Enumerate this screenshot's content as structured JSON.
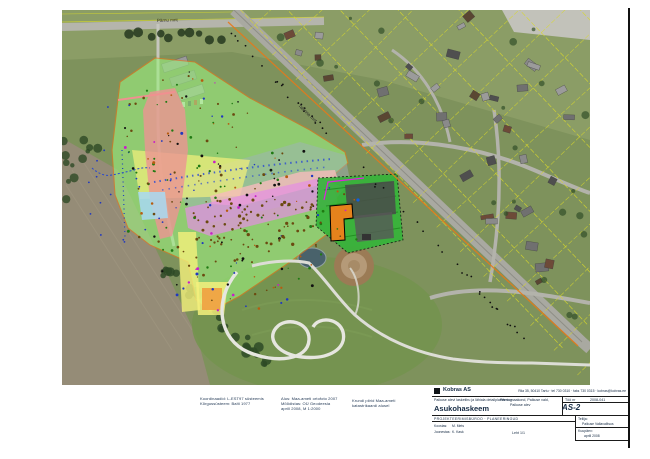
{
  "colors": {
    "zone_green": "#9CEF7E",
    "zone_red": "#EC9494",
    "zone_yellow": "#F4F07C",
    "zone_blue": "#A8D9F2",
    "zone_magenta": "#E48FE3",
    "zone_pink": "#F6BCBC",
    "zone_gray": "#9FB2BE",
    "facility_green": "#36B43A",
    "building_orange": "#E5821C",
    "boundary_orange": "#E87818",
    "parcel_yellow": "#D9D92A",
    "pond": "#49626B",
    "arena_brown": "#9B7B55"
  },
  "map_labels": {
    "street_top": "Pärnu mnt",
    "street_diagonal": "Tallinna mnt"
  },
  "notes": {
    "n1": [
      "Koordinaadid: L-EST97 süsteemis",
      "Kõrgussüsteem: Balti 1977"
    ],
    "n2": [
      "Alus: Maa-ameti ortofoto 2007",
      "Mõõdistas: OÜ Geodeesia",
      "aprill 2008, M 1:2000"
    ],
    "n3": [
      "Krundi piirid Maa-ameti",
      "katastrikaardi alusel"
    ]
  },
  "title_block": {
    "company": "Kobras AS",
    "contacts": "Riia 35, 50410 Tartu · tel 730 0310 · faks 730 0315 · kobras@kobras.ee",
    "project_line": "Paikuse alevi lasketiiru ja lähiala detailplaneering",
    "title": "Asukohaskeem",
    "mid_line1": "Pärnu maakond, Paikuse vald,",
    "mid_line2": "Paikuse alev",
    "work_label": "Töö nr",
    "work_no": "2008-041",
    "doc_no": "AS-2",
    "bureau_caps": "PROJEKTEERIMISBÜROO · PLANEERINGUD",
    "r1_label": "Koostas:",
    "r1_value": "M. Mets",
    "r2_label": "Joonestas:",
    "r2_value": "K. Kask",
    "sheet": "Leht 1/1",
    "client_label": "Tellija:",
    "client_value": "Paikuse Vallavalitsus",
    "date_label": "Kuupäev:",
    "date_value": "aprill 2008"
  }
}
